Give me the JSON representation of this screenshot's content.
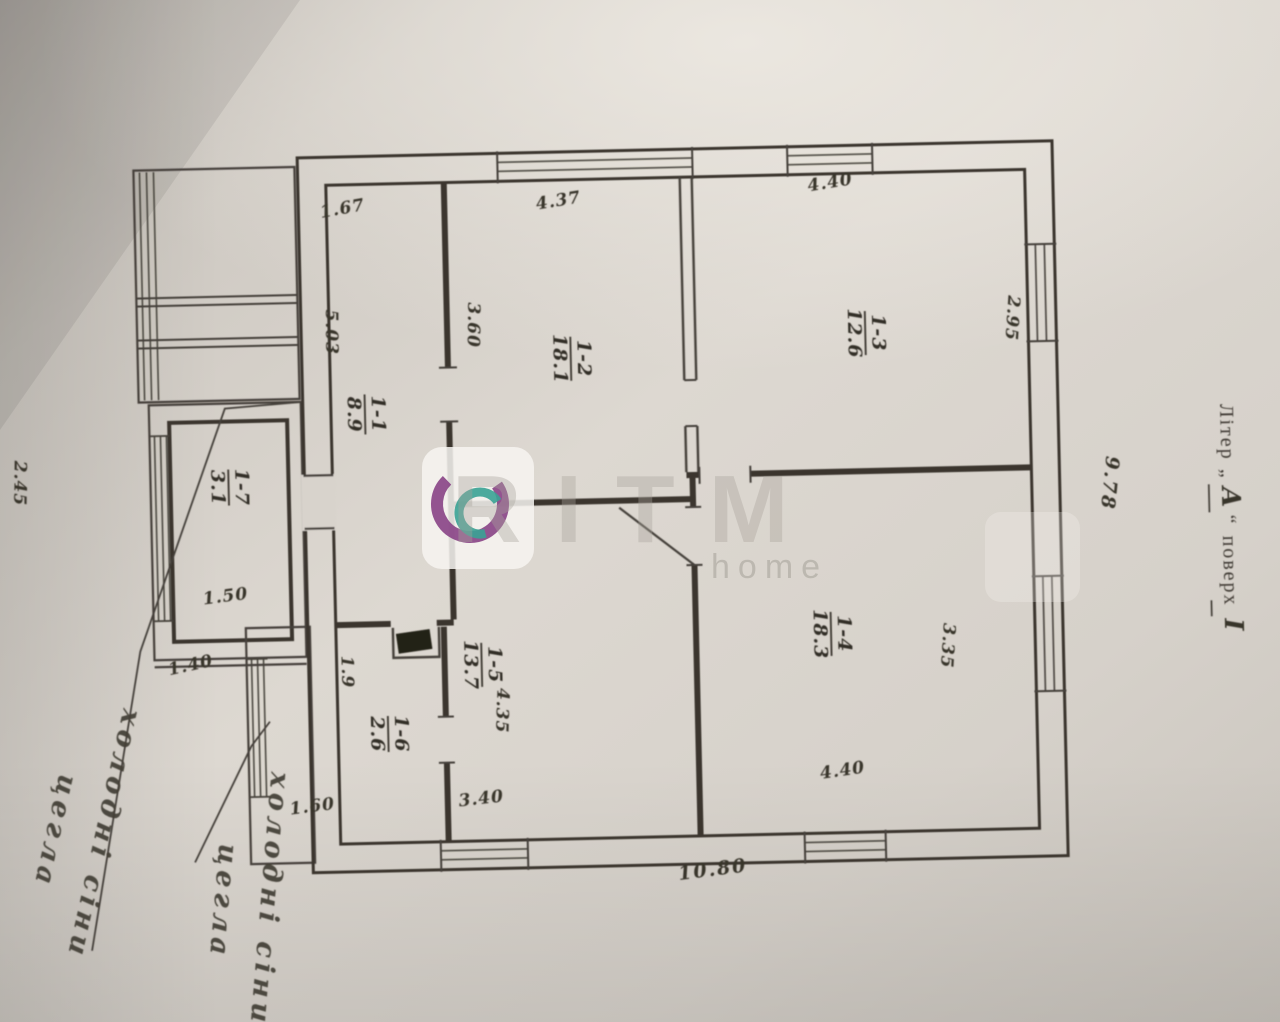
{
  "caption": {
    "liter": "Літер",
    "quote_open": "„",
    "letter": "А",
    "quote_close": "“",
    "floor_word": "поверх",
    "floor_num": "І"
  },
  "overall": {
    "bottom": "10.80",
    "right": "9.78"
  },
  "rooms": {
    "r11": {
      "num": "1-1",
      "area": "8.9"
    },
    "r12": {
      "num": "1-2",
      "area": "18.1"
    },
    "r13": {
      "num": "1-3",
      "area": "12.6"
    },
    "r14": {
      "num": "1-4",
      "area": "18.3"
    },
    "r15": {
      "num": "1-5",
      "area": "13.7"
    },
    "r16": {
      "num": "1-6",
      "area": "2.6"
    },
    "annex": {
      "num": "1-7",
      "area": "3.1"
    }
  },
  "dims": {
    "corridor_top": "1.67",
    "corridor_left": "5.03",
    "room12_top": "4.37",
    "room12_left": "3.60",
    "room13_top": "4.40",
    "room13_right": "2.95",
    "room14_bottom": "4.40",
    "room14_right": "3.35",
    "room15_bottom": "3.40",
    "room15_left": "4.35",
    "room16_top": "1.9",
    "room16_bottom": "1.60",
    "annex_bottom": "1.50",
    "annex_below": "1.40",
    "annex_left": "2.45"
  },
  "notes": {
    "note1": {
      "line1": "холодні сіни",
      "line2": "цегла"
    },
    "note2": {
      "line1": "холодні сіни",
      "line2": "цегла"
    }
  },
  "watermark": {
    "brand": "RITM",
    "sub": "home"
  }
}
